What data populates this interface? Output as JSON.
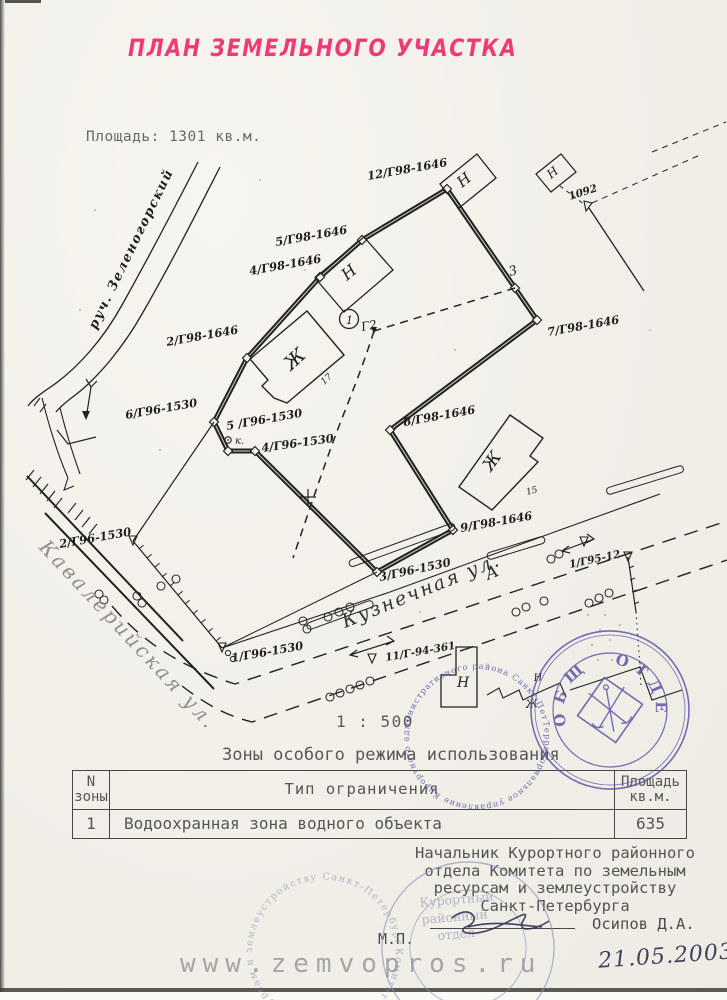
{
  "page": {
    "title": "ПЛАН ЗЕМЕЛЬНОГО УЧАСТКА",
    "area_text": "Площадь: 1301 кв.м.",
    "scale_text": "1 : 500"
  },
  "map": {
    "stream_label": "руч. Зеленогорский",
    "streets": {
      "kuznechnaya": "Кузнечная ул.",
      "kuznechnaya_letter": "А",
      "kavaleriyskaya": "Кавалерийская ул."
    },
    "labels": [
      {
        "text": "12/Г98-1646"
      },
      {
        "text": "5/Г98-1646"
      },
      {
        "text": "4/Г98-1646"
      },
      {
        "text": "2/Г98-1646"
      },
      {
        "text": "7/Г98-1646"
      },
      {
        "text": "8/Г98-1646"
      },
      {
        "text": "9/Г98-1646"
      },
      {
        "text": "6/Г96-1530"
      },
      {
        "text": "5 /Г96-1530"
      },
      {
        "text": "4/Г96-1530"
      },
      {
        "text": "3/Г96-1530"
      },
      {
        "text": "2/Г96-1530"
      },
      {
        "text": "1/Г96-1530"
      },
      {
        "text": "1/Г95-12"
      },
      {
        "text": "11/Г-94-361"
      },
      {
        "text": "1092"
      }
    ],
    "points": {
      "circled": "1",
      "g2": "Г2",
      "p3": "3",
      "well": "к."
    },
    "buildings": {
      "residential": "Ж",
      "nonresidential": "Н",
      "num15": "15",
      "num17": "17"
    }
  },
  "zones": {
    "heading": "Зоны особого режима использования",
    "table": {
      "col_zone_line1": "N",
      "col_zone_line2": "зоны",
      "col_type": "Тип ограничения",
      "col_area_line1": "Площадь",
      "col_area_line2": "кв.м.",
      "row": {
        "zone": "1",
        "type": "Водоохранная зона водного объекта",
        "area": "635"
      }
    }
  },
  "signature": {
    "line1": "Начальник Курортного районного",
    "line2": "отдела Комитета по земельным",
    "line3": "ресурсам и землеустройству",
    "line4": "Санкт-Петербурга",
    "name": "Осипов Д.А.",
    "seal_mark": "М.П."
  },
  "stamps": {
    "round_blue": {
      "ring": "Территориальное управление Курортного административного района Санкт-Петербурга *",
      "word_top": "ОБЩИЙ",
      "word_side": "ОТДЕЛ",
      "color": "#5c55a8"
    },
    "faint": {
      "ring": "Комитет по земельным ресурсам и землеустройству Санкт-Петербурга",
      "line1": "Курортный",
      "line2": "районный",
      "line3": "отдел"
    }
  },
  "footer": {
    "watermark": "www.zemvopros.ru",
    "date": "21.05.2003 г."
  }
}
